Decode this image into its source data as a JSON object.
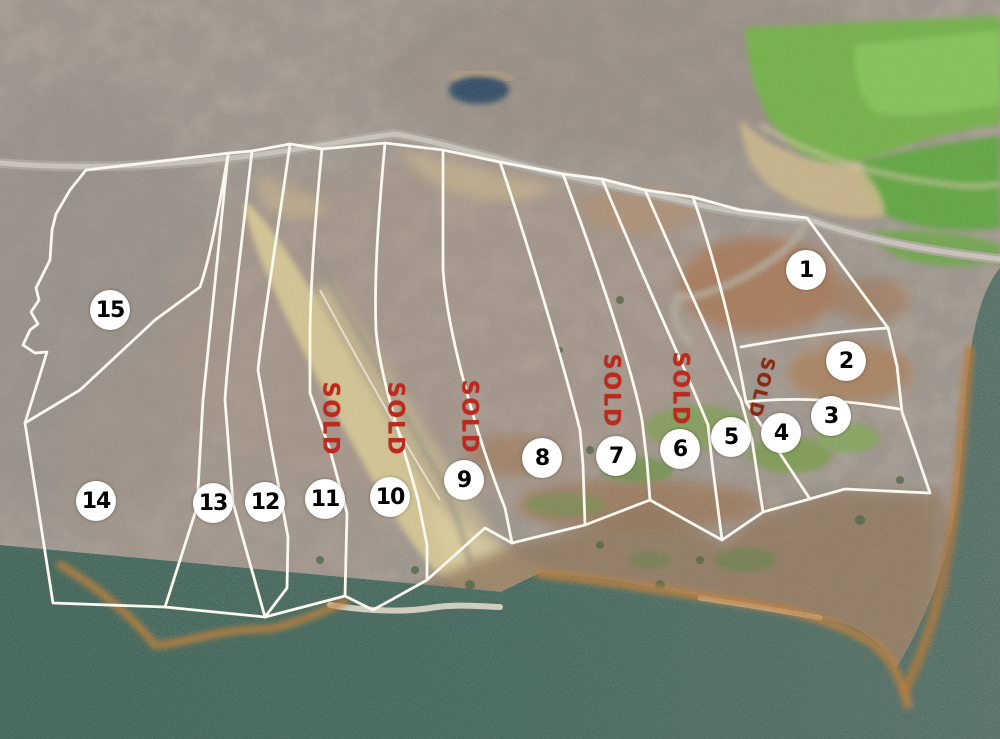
{
  "map": {
    "title": "Aerial subdivision lot map with lake frontage",
    "lots": [
      {
        "label": "1",
        "sold": false
      },
      {
        "label": "2",
        "sold": false
      },
      {
        "label": "3",
        "sold": false
      },
      {
        "label": "4",
        "sold": true
      },
      {
        "label": "5",
        "sold": false
      },
      {
        "label": "6",
        "sold": true
      },
      {
        "label": "7",
        "sold": true
      },
      {
        "label": "8",
        "sold": false
      },
      {
        "label": "9",
        "sold": true
      },
      {
        "label": "10",
        "sold": true
      },
      {
        "label": "11",
        "sold": true
      },
      {
        "label": "12",
        "sold": false
      },
      {
        "label": "13",
        "sold": false
      },
      {
        "label": "14",
        "sold": false
      },
      {
        "label": "15",
        "sold": false
      }
    ],
    "sold_markers": [
      {
        "text": "SOLD",
        "lot": "11"
      },
      {
        "text": "SOLD",
        "lot": "10"
      },
      {
        "text": "SOLD",
        "lot": "9"
      },
      {
        "text": "SOLD",
        "lot": "7"
      },
      {
        "text": "SOLD",
        "lot": "6"
      },
      {
        "text": "SOLD",
        "lot": "4"
      }
    ],
    "colors": {
      "boundary_line": "#FAF7EE",
      "sold_red": "#C1271D",
      "sold_red_dark": "#8A2A12",
      "lot_circle_fill": "#FFFFFF",
      "lot_number": "#000000",
      "water": "#3D6055",
      "pasture_green": "#6FAE45",
      "cleared_dirt_tan": "#D3C591",
      "road_gray": "#B6B1A8"
    }
  }
}
